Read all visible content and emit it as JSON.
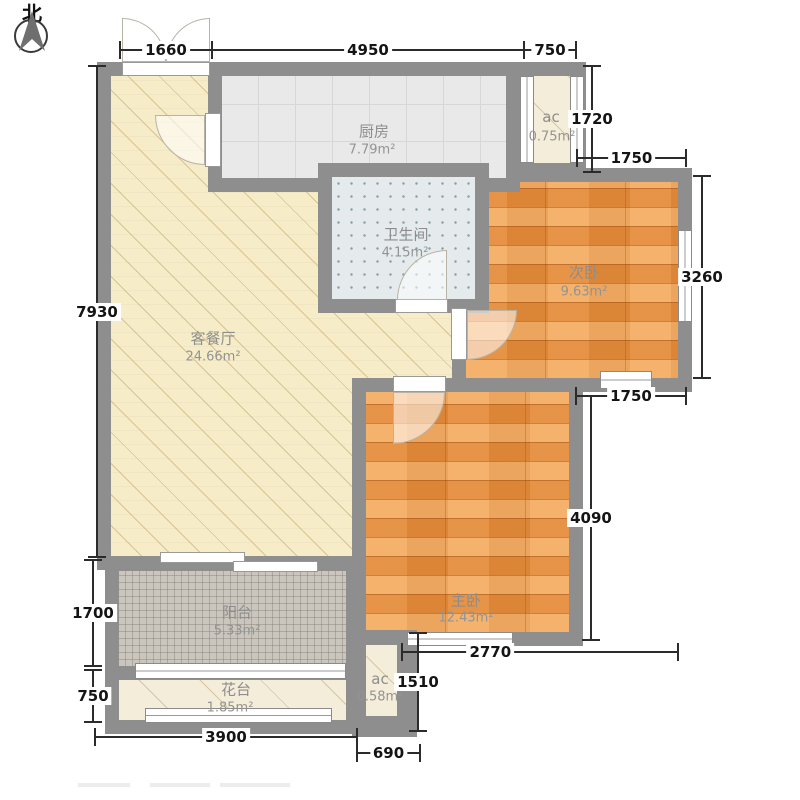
{
  "compass": {
    "label": "北"
  },
  "rooms": {
    "kitchen": {
      "name": "厨房",
      "area": "7.79m²"
    },
    "ac_top": {
      "name": "ac",
      "area": "0.75m²"
    },
    "bathroom": {
      "name": "卫生间",
      "area": "4.15m²"
    },
    "bedroom2": {
      "name": "次卧",
      "area": "9.63m²"
    },
    "living": {
      "name": "客餐厅",
      "area": "24.66m²"
    },
    "bedroom1": {
      "name": "主卧",
      "area": "12.43m²"
    },
    "balcony": {
      "name": "阳台",
      "area": "5.33m²"
    },
    "flowerbed": {
      "name": "花台",
      "area": "1.85m²"
    },
    "ac_bottom": {
      "name": "ac",
      "area": "0.58m²"
    }
  },
  "dimensions": {
    "entry_width": "1660",
    "kitchen_width": "4950",
    "ac_top_width": "750",
    "ac_top_height": "1720",
    "bedroom2_top_width": "1750",
    "bedroom2_height": "3260",
    "bedroom2_bottom_width": "1750",
    "bedroom1_height": "4090",
    "left_total_height": "7930",
    "balcony_height": "1700",
    "flowerbed_height": "750",
    "bedroom1_bottom_width": "2770",
    "ac_bottom_height": "1510",
    "flowerbed_width": "3900",
    "ac_bottom_width": "690"
  },
  "icons": {
    "compass_arrow": "north-arrow"
  },
  "colors": {
    "wall": "#8e8e8e",
    "living_floor": "#f6ecc8",
    "wood_floor": "#ee9440",
    "kitchen_floor": "#e9e9e9",
    "bath_floor": "#e5ebec",
    "balcony_floor": "#cac6be",
    "accent_dim_text": "#141414",
    "room_label_text": "#8d8d8d"
  }
}
